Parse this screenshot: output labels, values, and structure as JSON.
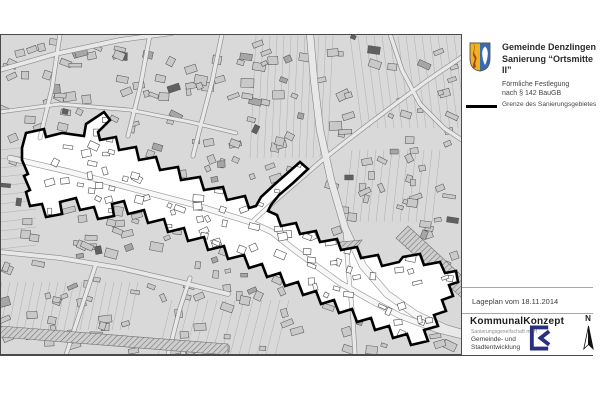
{
  "header": {
    "municipality": "Gemeinde Denzlingen",
    "project": "Sanierung “Ortsmitte II”",
    "subtitle_line1": "Förmliche Festlegung",
    "subtitle_line2": "nach § 142 BauGB"
  },
  "legend": {
    "items": [
      {
        "symbol": "thick-black-line",
        "label": "Grenze des Sanierungsgebietes"
      }
    ]
  },
  "footer": {
    "plan_date_label": "Lageplan vom 18.11.2014",
    "firm_name": "KommunalKonzept",
    "firm_subtitle": "Sanierungsgesellschaft mbH",
    "firm_desc_line1": "Gemeinde- und",
    "firm_desc_line2": "Stadtentwicklung",
    "north_label": "N"
  },
  "colors": {
    "map_bg": "#d9d9d9",
    "parcel_line": "#aeaeae",
    "building": "#c9c9c9",
    "building_dark": "#a6a6a6",
    "building_darkest": "#606060",
    "building_stroke": "#4d4d4d",
    "street": "#e8e8e8",
    "street_casing": "#8c8c8c",
    "area_fill": "#ffffff",
    "area_street": "#f7f7f7",
    "area_street_casing": "#9b9b9b",
    "boundary": "#000000",
    "frame": "#4a4a4a",
    "hatch_line": "#707070",
    "divider": "#a8a8a8",
    "crest_gold": "#e9b621",
    "crest_red": "#c3331f",
    "crest_blue": "#3a6cb0",
    "logo_navy": "#2a2f80"
  },
  "map": {
    "boundary": [
      [
        22,
        148
      ],
      [
        26,
        133
      ],
      [
        44,
        129
      ],
      [
        46,
        137
      ],
      [
        62,
        133
      ],
      [
        84,
        136
      ],
      [
        86,
        124
      ],
      [
        104,
        112
      ],
      [
        110,
        120
      ],
      [
        98,
        132
      ],
      [
        100,
        140
      ],
      [
        116,
        137
      ],
      [
        119,
        150
      ],
      [
        136,
        147
      ],
      [
        139,
        160
      ],
      [
        156,
        157
      ],
      [
        160,
        170
      ],
      [
        178,
        167
      ],
      [
        181,
        180
      ],
      [
        200,
        177
      ],
      [
        204,
        190
      ],
      [
        223,
        187
      ],
      [
        227,
        200
      ],
      [
        245,
        196
      ],
      [
        249,
        208
      ],
      [
        256,
        206
      ],
      [
        261,
        197
      ],
      [
        275,
        184
      ],
      [
        291,
        170
      ],
      [
        300,
        162
      ],
      [
        308,
        169
      ],
      [
        293,
        183
      ],
      [
        279,
        195
      ],
      [
        271,
        205
      ],
      [
        268,
        211
      ],
      [
        277,
        215
      ],
      [
        281,
        226
      ],
      [
        296,
        223
      ],
      [
        300,
        234
      ],
      [
        316,
        231
      ],
      [
        320,
        242
      ],
      [
        337,
        239
      ],
      [
        341,
        250
      ],
      [
        357,
        247
      ],
      [
        361,
        258
      ],
      [
        378,
        255
      ],
      [
        382,
        266
      ],
      [
        399,
        262
      ],
      [
        403,
        257
      ],
      [
        420,
        254
      ],
      [
        424,
        265
      ],
      [
        440,
        262
      ],
      [
        445,
        273
      ],
      [
        456,
        271
      ],
      [
        458,
        282
      ],
      [
        449,
        285
      ],
      [
        453,
        296
      ],
      [
        442,
        300
      ],
      [
        446,
        311
      ],
      [
        434,
        315
      ],
      [
        438,
        326
      ],
      [
        424,
        330
      ],
      [
        428,
        341
      ],
      [
        411,
        345
      ],
      [
        407,
        334
      ],
      [
        393,
        338
      ],
      [
        389,
        326
      ],
      [
        375,
        330
      ],
      [
        371,
        318
      ],
      [
        357,
        322
      ],
      [
        352,
        309
      ],
      [
        339,
        313
      ],
      [
        334,
        300
      ],
      [
        321,
        304
      ],
      [
        316,
        291
      ],
      [
        303,
        295
      ],
      [
        298,
        282
      ],
      [
        285,
        286
      ],
      [
        280,
        273
      ],
      [
        267,
        277
      ],
      [
        262,
        264
      ],
      [
        249,
        268
      ],
      [
        244,
        255
      ],
      [
        228,
        259
      ],
      [
        224,
        246
      ],
      [
        208,
        250
      ],
      [
        204,
        237
      ],
      [
        188,
        241
      ],
      [
        184,
        228
      ],
      [
        168,
        232
      ],
      [
        164,
        219
      ],
      [
        148,
        223
      ],
      [
        144,
        210
      ],
      [
        128,
        214
      ],
      [
        124,
        201
      ],
      [
        112,
        204
      ],
      [
        114,
        216
      ],
      [
        98,
        219
      ],
      [
        94,
        207
      ],
      [
        80,
        210
      ],
      [
        76,
        198
      ],
      [
        60,
        202
      ],
      [
        62,
        214
      ],
      [
        46,
        217
      ],
      [
        42,
        204
      ],
      [
        30,
        206
      ],
      [
        26,
        192
      ],
      [
        30,
        190
      ],
      [
        24,
        176
      ],
      [
        28,
        174
      ],
      [
        22,
        160
      ]
    ],
    "streets": [
      {
        "w": 5,
        "pts": [
          [
            10,
            158
          ],
          [
            70,
            172
          ],
          [
            130,
            188
          ],
          [
            195,
            205
          ],
          [
            250,
            222
          ],
          [
            272,
            232
          ],
          [
            292,
            248
          ],
          [
            315,
            265
          ],
          [
            340,
            283
          ],
          [
            370,
            300
          ],
          [
            400,
            316
          ],
          [
            438,
            330
          ],
          [
            462,
            336
          ]
        ]
      },
      {
        "w": 3.5,
        "pts": [
          [
            254,
            220
          ],
          [
            276,
            200
          ],
          [
            298,
            181
          ],
          [
            320,
            162
          ],
          [
            344,
            143
          ],
          [
            370,
            123
          ],
          [
            398,
            102
          ],
          [
            428,
            80
          ],
          [
            462,
            57
          ]
        ]
      },
      {
        "w": 6.5,
        "pts": [
          [
            310,
            34
          ],
          [
            314,
            80
          ],
          [
            320,
            130
          ],
          [
            331,
            180
          ],
          [
            345,
            228
          ],
          [
            363,
            266
          ],
          [
            387,
            294
          ],
          [
            415,
            314
          ],
          [
            445,
            328
          ],
          [
            462,
            333
          ]
        ]
      },
      {
        "w": 3.5,
        "pts": [
          [
            345,
            228
          ],
          [
            349,
            278
          ],
          [
            353,
            320
          ],
          [
            355,
            355
          ]
        ]
      },
      {
        "w": 4,
        "pts": [
          [
            0,
            70
          ],
          [
            55,
            54
          ],
          [
            120,
            40
          ],
          [
            172,
            33
          ]
        ]
      },
      {
        "w": 3.5,
        "pts": [
          [
            60,
            34
          ],
          [
            52,
            88
          ],
          [
            40,
            138
          ]
        ]
      },
      {
        "w": 3.5,
        "pts": [
          [
            150,
            34
          ],
          [
            140,
            88
          ],
          [
            128,
            136
          ]
        ]
      },
      {
        "w": 3.5,
        "pts": [
          [
            222,
            34
          ],
          [
            212,
            82
          ],
          [
            200,
            128
          ],
          [
            193,
            156
          ]
        ]
      },
      {
        "w": 4,
        "pts": [
          [
            0,
            252
          ],
          [
            60,
            258
          ],
          [
            120,
            268
          ],
          [
            180,
            282
          ],
          [
            228,
            294
          ]
        ]
      },
      {
        "w": 3.5,
        "pts": [
          [
            66,
            355
          ],
          [
            84,
            300
          ],
          [
            96,
            264
          ]
        ]
      },
      {
        "w": 3.5,
        "pts": [
          [
            168,
            355
          ],
          [
            180,
            308
          ],
          [
            190,
            278
          ]
        ]
      },
      {
        "w": 3.5,
        "pts": [
          [
            390,
            34
          ],
          [
            402,
            70
          ],
          [
            420,
            104
          ],
          [
            444,
            128
          ],
          [
            462,
            140
          ]
        ]
      },
      {
        "w": 3,
        "pts": [
          [
            0,
            112
          ],
          [
            60,
            104
          ],
          [
            130,
            110
          ],
          [
            190,
            122
          ],
          [
            236,
            133
          ]
        ]
      }
    ],
    "hatch_areas": [
      [
        [
          0,
          326
        ],
        [
          228,
          344
        ],
        [
          228,
          355
        ],
        [
          0,
          337
        ]
      ],
      [
        [
          408,
          226
        ],
        [
          462,
          276
        ],
        [
          462,
          298
        ],
        [
          396,
          238
        ]
      ],
      [
        [
          320,
          244
        ],
        [
          362,
          240
        ],
        [
          342,
          268
        ]
      ]
    ],
    "strip_groups": [
      {
        "x1": 256,
        "y1": 36,
        "x2": 250,
        "y2": 158,
        "dx": 7,
        "dy": 0,
        "count": 12
      },
      {
        "x1": 350,
        "y1": 36,
        "x2": 362,
        "y2": 128,
        "dx": 8,
        "dy": 0,
        "count": 14
      },
      {
        "x1": 352,
        "y1": 150,
        "x2": 344,
        "y2": 222,
        "dx": 8,
        "dy": 0,
        "count": 12
      },
      {
        "x1": 172,
        "y1": 300,
        "x2": 158,
        "y2": 355,
        "dx": 9,
        "dy": 0,
        "count": 14
      },
      {
        "x1": 2,
        "y1": 282,
        "x2": -8,
        "y2": 330,
        "dx": 8,
        "dy": 0,
        "count": 18
      },
      {
        "x1": 0,
        "y1": 150,
        "x2": 36,
        "y2": 146,
        "dx": 0,
        "dy": 9,
        "count": 12
      }
    ],
    "buildings": {
      "seed": 42,
      "count": 330,
      "inside_extra": 300
    }
  }
}
